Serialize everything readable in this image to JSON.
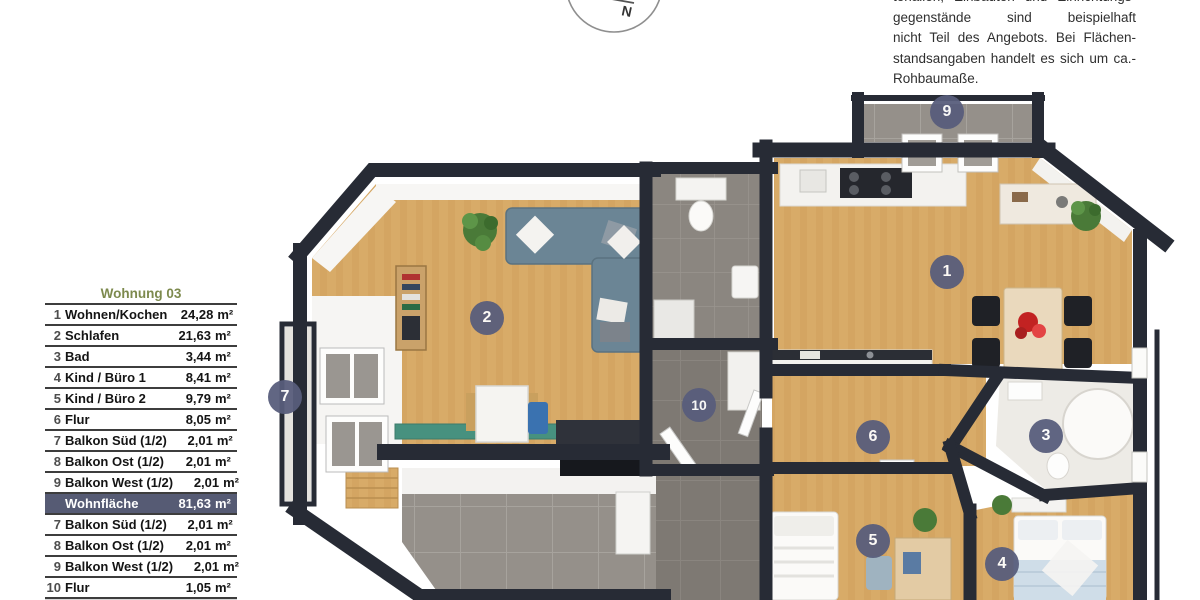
{
  "colors": {
    "wall": "#272b35",
    "wood": "#d8ab68",
    "wood2": "#cfa05b",
    "tile-light": "#95908a",
    "tile-dark": "#7e7973",
    "tile-mid": "#8b8680",
    "bath-floor": "#edebe6",
    "badge": "#585d7c",
    "table-line": "#3d3d3d",
    "table-title": "#7d8a4e",
    "highlight-bg": "#565b74",
    "sofa": "#6b8595",
    "plant": "#4a7a38",
    "teal-table": "#47917f",
    "table-top": "#ead9bd",
    "accent-red": "#c22222",
    "bed-blanket": "#cfdde8"
  },
  "notice": {
    "lines": [
      "terialien, Einbauten und Einrichtungs-",
      "gegenstände sind beispielhaft dargestellt und",
      "nicht Teil des Angebots. Bei Flächen- und Ab-",
      "standsangaben handelt es sich um ca.-",
      "Rohbaumaße."
    ]
  },
  "compass": {
    "label": "N"
  },
  "area_table": {
    "title": "Wohnung 03",
    "rows": [
      {
        "num": "1",
        "label": "Wohnen/Kochen",
        "value": "24,28",
        "unit": "m²"
      },
      {
        "num": "2",
        "label": "Schlafen",
        "value": "21,63",
        "unit": "m²"
      },
      {
        "num": "3",
        "label": "Bad",
        "value": "3,44",
        "unit": "m²"
      },
      {
        "num": "4",
        "label": "Kind / Büro 1",
        "value": "8,41",
        "unit": "m²"
      },
      {
        "num": "5",
        "label": "Kind / Büro 2",
        "value": "9,79",
        "unit": "m²"
      },
      {
        "num": "6",
        "label": "Flur",
        "value": "8,05",
        "unit": "m²"
      },
      {
        "num": "7",
        "label": "Balkon Süd (1/2)",
        "value": "2,01",
        "unit": "m²"
      },
      {
        "num": "8",
        "label": "Balkon Ost (1/2)",
        "value": "2,01",
        "unit": "m²"
      },
      {
        "num": "9",
        "label": "Balkon West (1/2)",
        "value": "2,01",
        "unit": "m²"
      }
    ],
    "total": {
      "label": "Wohnfläche",
      "value": "81,63",
      "unit": "m²"
    },
    "extra_rows": [
      {
        "num": "7",
        "label": "Balkon Süd (1/2)",
        "value": "2,01",
        "unit": "m²"
      },
      {
        "num": "8",
        "label": "Balkon Ost (1/2)",
        "value": "2,01",
        "unit": "m²"
      },
      {
        "num": "9",
        "label": "Balkon West (1/2)",
        "value": "2,01",
        "unit": "m²"
      },
      {
        "num": "10",
        "label": "Flur",
        "value": "1,05",
        "unit": "m²"
      }
    ]
  },
  "plan": {
    "badges": [
      {
        "number": "1",
        "room": "Wohnen/Kochen"
      },
      {
        "number": "2",
        "room": "Schlafen"
      },
      {
        "number": "3",
        "room": "Bad"
      },
      {
        "number": "4",
        "room": "Kind / Büro 1"
      },
      {
        "number": "5",
        "room": "Kind / Büro 2"
      },
      {
        "number": "6",
        "room": "Flur"
      },
      {
        "number": "7",
        "room": "Balkon Süd"
      },
      {
        "number": "9",
        "room": "Balkon West"
      },
      {
        "number": "10",
        "room": "Flur"
      }
    ]
  }
}
